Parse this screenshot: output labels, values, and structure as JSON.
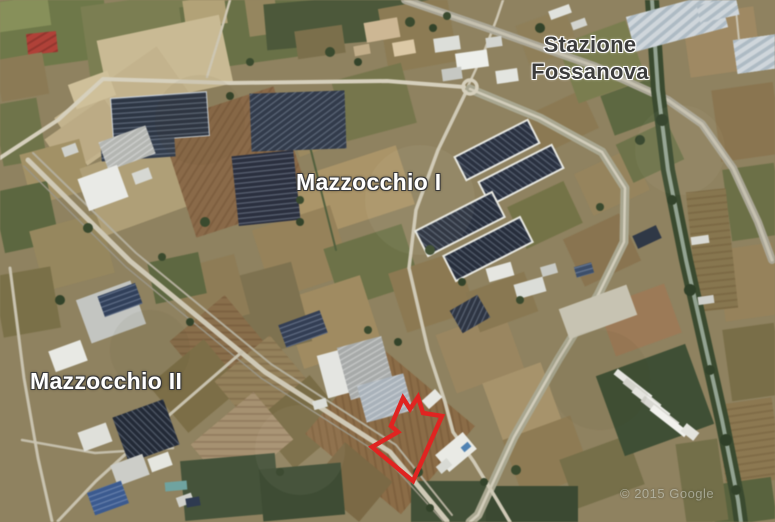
{
  "map": {
    "labels": {
      "stazione": {
        "text": "Stazione\nFossanova"
      },
      "mazzocchio1": {
        "text": "Mazzocchio I"
      },
      "mazzocchio2": {
        "text": "Mazzocchio II"
      }
    },
    "attribution": "© 2015 Google",
    "annotation": {
      "polygon_points": "403,398 410,409 418,397 423,413 442,416 413,481 372,447 398,432 391,426",
      "color": "#e02421",
      "stroke_width": 4.5
    },
    "colors": {
      "label_dark": "#3c3c3c",
      "label_light": "#ffffff",
      "annotation_red": "#e02421"
    }
  }
}
